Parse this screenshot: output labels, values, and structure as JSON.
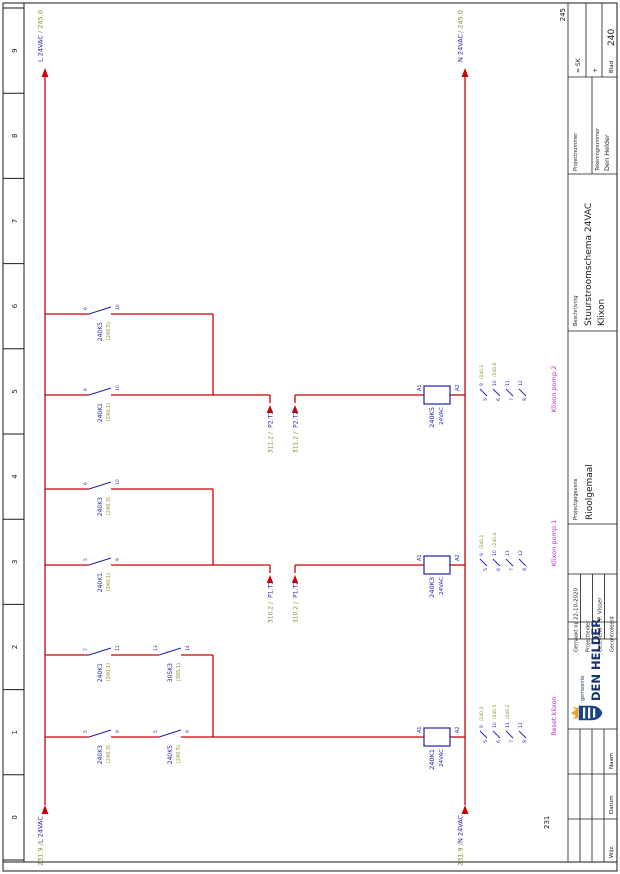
{
  "page": {
    "prev_sheet": "231",
    "next_sheet": "245"
  },
  "ruler": [
    "0",
    "1",
    "2",
    "3",
    "4",
    "5",
    "6",
    "7",
    "8",
    "9"
  ],
  "rails": {
    "l_src_ref": "231.9 /",
    "l_src": "L 24VAC",
    "l_dst": "L 24VAC",
    "l_dst_ref": "/ 245.0",
    "n_src_ref": "231.9 /",
    "n_src": "N 24VAC",
    "n_dst": "N 24VAC",
    "n_dst_ref": "/ 245.0"
  },
  "contacts": [
    {
      "name": "240K3",
      "ref": "(240.3)",
      "top": "5",
      "bot": "9"
    },
    {
      "name": "240K5",
      "ref": "(240.5)",
      "top": "5",
      "bot": "9"
    },
    {
      "name": "240K1",
      "ref": "(240.1)",
      "top": "7",
      "bot": "11"
    },
    {
      "name": "305K3",
      "ref": "(305.1)",
      "top": "13",
      "bot": "14"
    },
    {
      "name": "240K1",
      "ref": "(240.1)",
      "top": "5",
      "bot": "9"
    },
    {
      "name": "240K3",
      "ref": "(240.3)",
      "top": "6",
      "bot": "10"
    },
    {
      "name": "240K1",
      "ref": "(240.1)",
      "top": "6",
      "bot": "10"
    },
    {
      "name": "240K5",
      "ref": "(240.5)",
      "top": "6",
      "bot": "10"
    }
  ],
  "coils": [
    {
      "name": "240K1",
      "volt": "24VAC",
      "a1": "A1",
      "a2": "A2"
    },
    {
      "name": "240K3",
      "volt": "24VAC",
      "a1": "A1",
      "a2": "A2"
    },
    {
      "name": "240K5",
      "volt": "24VAC",
      "a1": "A1",
      "a2": "A2"
    }
  ],
  "mirrors": [
    [
      {
        "l": "5",
        "r": "9",
        "ref": "/240.3"
      },
      {
        "l": "6",
        "r": "10",
        "ref": "/240.5"
      },
      {
        "l": "7",
        "r": "11",
        "ref": "/240.2"
      },
      {
        "l": "8",
        "r": "12",
        "ref": ""
      }
    ],
    [
      {
        "l": "5",
        "r": "9",
        "ref": "/240.1"
      },
      {
        "l": "6",
        "r": "10",
        "ref": "/240.4"
      },
      {
        "l": "7",
        "r": "11",
        "ref": ""
      },
      {
        "l": "8",
        "r": "12",
        "ref": ""
      }
    ],
    [
      {
        "l": "5",
        "r": "9",
        "ref": "/240.1"
      },
      {
        "l": "6",
        "r": "10",
        "ref": "/240.6"
      },
      {
        "l": "7",
        "r": "11",
        "ref": ""
      },
      {
        "l": "8",
        "r": "12",
        "ref": ""
      }
    ]
  ],
  "interrupts": [
    {
      "ref": "310.2 /",
      "name": "P1.T1"
    },
    {
      "ref": "310.2 /",
      "name": "P1.T2"
    },
    {
      "ref": "311.2 /",
      "name": "P2.T1"
    },
    {
      "ref": "311.2 /",
      "name": "P2.T2"
    }
  ],
  "functions": [
    "Reset klixon",
    "Klixon pomp 1",
    "Klixon pomp 2"
  ],
  "titleblock": {
    "made_label": "Gemaakt op",
    "made_value": "22-10-2020",
    "lead_label": "Projectleider",
    "lead_value": "",
    "drawn_label": "Getekend",
    "drawn_value": "P. Visser",
    "check_label": "Gecontroleerd",
    "check_value": "",
    "rev_wijz": "Wijz.",
    "rev_datum": "Datum",
    "rev_naam": "Naam",
    "logo_small": "gemeente",
    "logo_big": "DEN HELDER",
    "project_label": "Projectgegevens",
    "project_value": "Rioolgemaal",
    "descr_label": "Beschrijving",
    "descr_line1": "Stuurstroomschema 24VAC",
    "descr_line2": "Klixon",
    "projnum_label": "Projectnummer",
    "projnum_value": "",
    "teknum_label": "Tekeningnummer",
    "teknum_value": "Den Helder",
    "plant": "= SK",
    "location": "+",
    "blad_label": "Blad",
    "blad_value": "240"
  },
  "colors": {
    "wire": "#cc0000",
    "device": "#1f1fb4",
    "ref": "#8b8b2a",
    "function": "#c325c3",
    "logo": "#16346e",
    "crown": "#e8a21e"
  }
}
